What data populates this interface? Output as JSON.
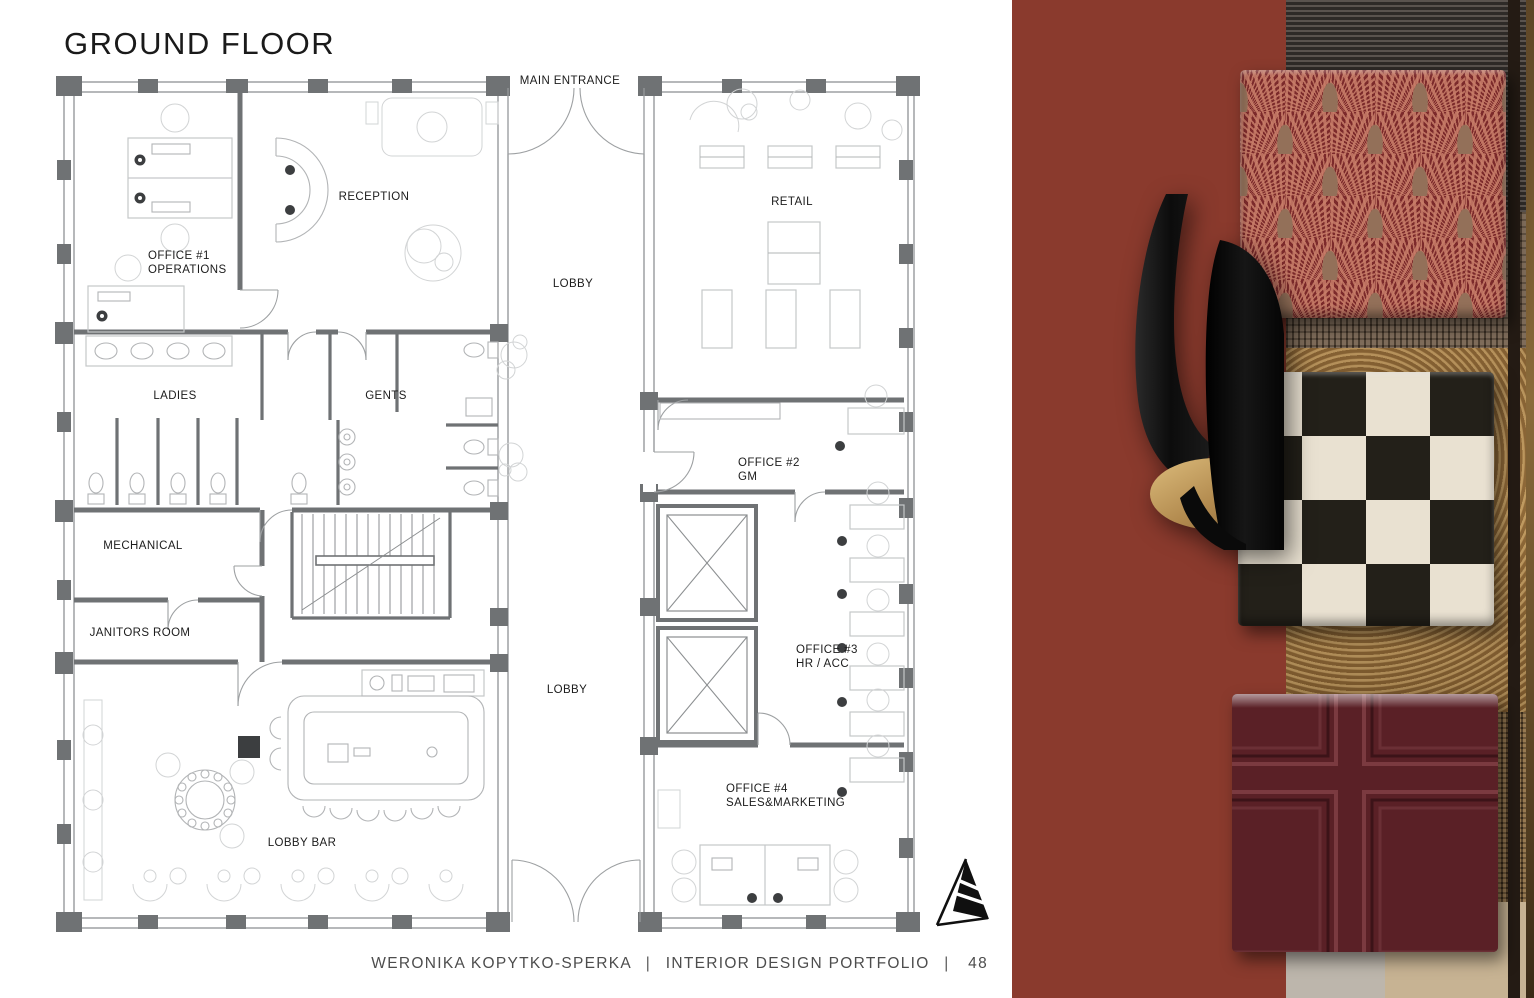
{
  "page": {
    "title": "GROUND FLOOR",
    "footer": {
      "author": "WERONIKA KOPYTKO-SPERKA",
      "separator1": "|",
      "portfolio": "INTERIOR DESIGN PORTFOLIO",
      "separator2": "|",
      "page_number": "48"
    }
  },
  "plan": {
    "rooms": [
      {
        "id": "main-entrance",
        "label": "MAIN ENTRANCE"
      },
      {
        "id": "reception",
        "label": "RECEPTION"
      },
      {
        "id": "office-1",
        "label": "OFFICE #1",
        "label2": "OPERATIONS"
      },
      {
        "id": "lobby-upper",
        "label": "LOBBY"
      },
      {
        "id": "retail",
        "label": "RETAIL"
      },
      {
        "id": "ladies",
        "label": "LADIES"
      },
      {
        "id": "gents",
        "label": "GENTS"
      },
      {
        "id": "office-2",
        "label": "OFFICE #2",
        "label2": "GM"
      },
      {
        "id": "mechanical",
        "label": "MECHANICAL"
      },
      {
        "id": "janitors-room",
        "label": "JANITORS ROOM"
      },
      {
        "id": "office-3",
        "label": "OFFICE #3",
        "label2": "HR / ACC"
      },
      {
        "id": "lobby-lower",
        "label": "LOBBY"
      },
      {
        "id": "office-4",
        "label": "OFFICE #4",
        "label2": "SALES&MARKETING"
      },
      {
        "id": "lobby-bar",
        "label": "LOBBY BAR"
      }
    ]
  },
  "materials": {
    "panel_color": "#8a3a2d",
    "swatches": [
      {
        "name": "art-deco-fan-velvet",
        "base_color": "#7c2a2b",
        "accent_color": "#c87d69",
        "center_color": "#937059"
      },
      {
        "name": "black-gold-wall-sconce",
        "body_color": "#111111",
        "gold_color": "#b28a4e"
      },
      {
        "name": "checkered-marble-tile",
        "light_color": "#e9e1d1",
        "dark_color": "#232019"
      },
      {
        "name": "burgundy-coffered-panel",
        "base_color": "#5a2026",
        "ridge_color": "#7b3a40"
      },
      {
        "name": "textured-glass-panels",
        "tones": [
          "#46403c",
          "#6d5843",
          "#a57c45",
          "#6e5334",
          "#c7b393"
        ]
      }
    ]
  }
}
